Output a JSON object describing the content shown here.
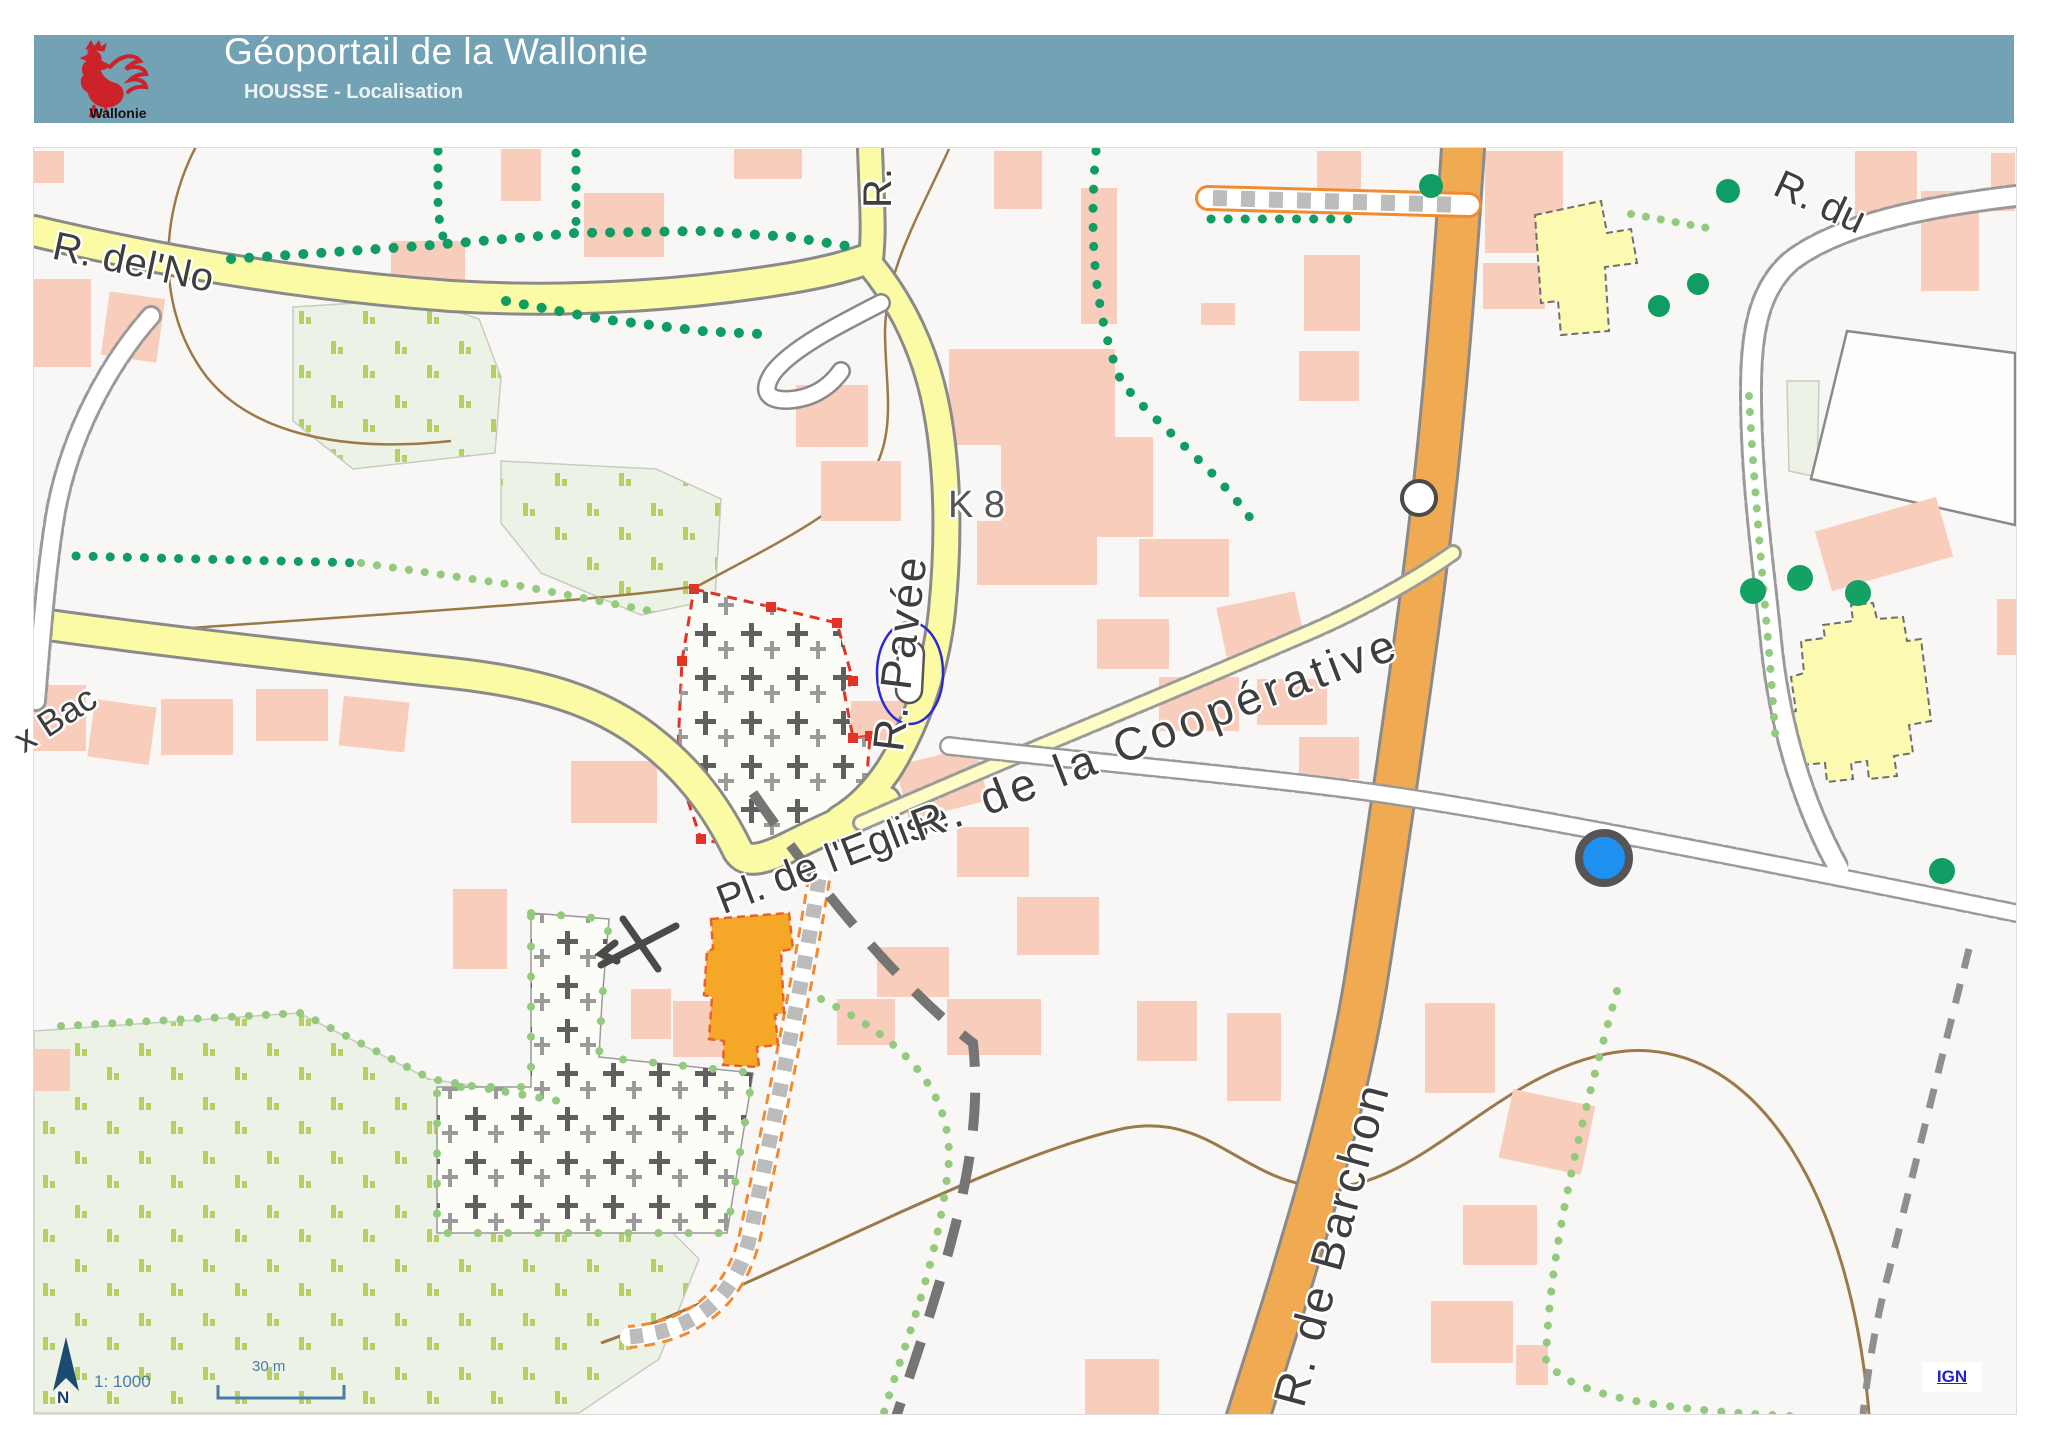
{
  "header": {
    "title": "Géoportail de la Wallonie",
    "subtitle": "HOUSSE - Localisation",
    "logo_caption": "Wallonie"
  },
  "map": {
    "labels": {
      "r_del_no": "R. del'No",
      "r_short": "R.",
      "r_pavee": "R. Pavée",
      "k8": "K 8",
      "pl_eglise": "Pl. de l'Eglise",
      "r_cooperative": "R. de la Coopérative",
      "r_barchon": "R. de Barchon",
      "r_du": "R. du",
      "bac": "x Bac"
    },
    "scalebar": {
      "ratio": "1: 1000",
      "distance": "30 m",
      "north": "N"
    },
    "attribution": {
      "link": "IGN"
    },
    "markers": {
      "selection_ellipse": "church-selection-circle",
      "white_circle": "poi-open-circle",
      "blue_dot": "poi-blue-dot",
      "selected_parcel": "cemetery-red-dashed-outline",
      "selected_building": "orange-building-dashed-outline"
    },
    "colors": {
      "header_band": "#72a2b4",
      "road_local_yellow": "#fbfba6",
      "road_main_orange": "#f0aa52",
      "building_pink": "#f9cdbb",
      "public_building_yellow": "#fbfab0",
      "selected_building_orange": "#f5a728",
      "orchard_green": "#edf2e6",
      "hedge_green": "#0f9d63",
      "tree_row_green": "#94ca7e",
      "contour_brown": "#9b7a4a",
      "selection_red": "#e23327",
      "selection_blue": "#2a2ad4",
      "poi_blue": "#1e90f0",
      "scale_blue": "#4a7ca6",
      "link_blue": "#2323cc"
    }
  }
}
